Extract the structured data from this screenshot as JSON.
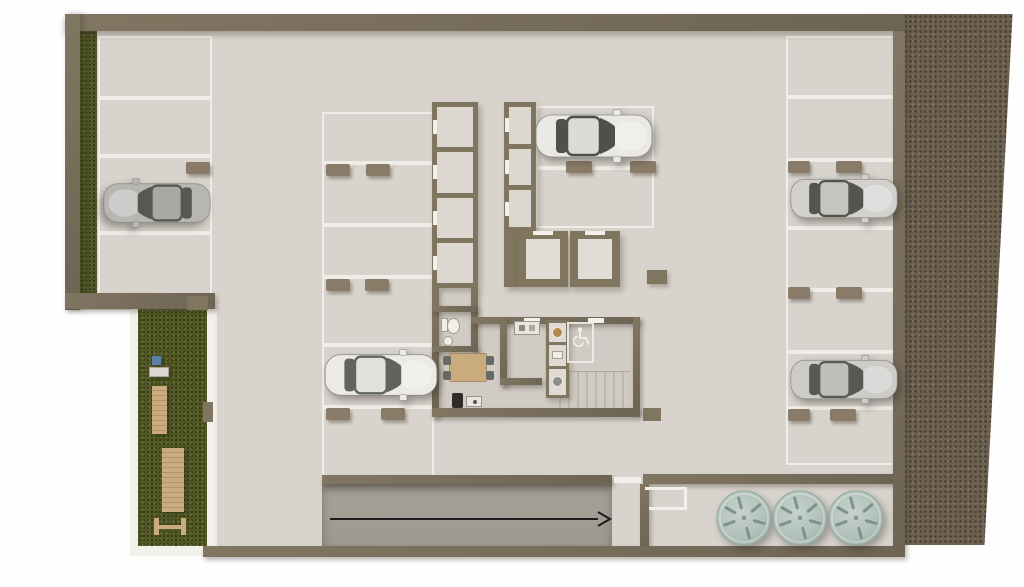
{
  "colors": {
    "page": "#fefefe",
    "wall": "#80755f",
    "wall_dark": "#6c6252",
    "floor": "#d8d4cd",
    "floor_core": "#d0cbc4",
    "ramp": "#a39e95",
    "line": "#f2f0ea",
    "hedge": "#4e5423",
    "grass": "#525823",
    "terrain": "#6d604f",
    "tank": "#b4c3bc",
    "tank_mark": "#7e938b",
    "wheel_stop": "#897b67",
    "wood": "#c9ab7d",
    "arrow": "#1d1d1d"
  },
  "symbols": {
    "accessible_parking": "wheelchair",
    "drive_direction": "arrow-right"
  },
  "plan": {
    "parking": {
      "total_spaces": 19,
      "columns": [
        {
          "id": "left",
          "x": 98,
          "w": 114,
          "lines_y": [
            36,
            98,
            156,
            233,
            298
          ],
          "stops": [
            {
              "x": 186,
              "y": 162,
              "w": 24
            }
          ]
        },
        {
          "id": "middle",
          "x": 322,
          "w": 112,
          "lines_y": [
            112,
            163,
            225,
            277,
            345,
            407,
            478
          ],
          "stops": [
            {
              "x": 326,
              "y": 164,
              "w": 24
            },
            {
              "x": 366,
              "y": 164,
              "w": 24
            },
            {
              "x": 326,
              "y": 279,
              "w": 24
            },
            {
              "x": 365,
              "y": 279,
              "w": 24
            },
            {
              "x": 326,
              "y": 408,
              "w": 24
            },
            {
              "x": 381,
              "y": 408,
              "w": 24
            }
          ]
        },
        {
          "id": "top-center",
          "x": 536,
          "w": 118,
          "lines_y": [
            106,
            168,
            228
          ],
          "stops": [
            {
              "x": 566,
              "y": 161,
              "w": 26
            },
            {
              "x": 630,
              "y": 161,
              "w": 26
            }
          ]
        },
        {
          "id": "right",
          "x": 786,
          "w": 112,
          "lines_y": [
            36,
            97,
            160,
            228,
            290,
            352,
            408,
            465
          ],
          "stops": [
            {
              "x": 788,
              "y": 161,
              "w": 22
            },
            {
              "x": 836,
              "y": 161,
              "w": 26
            },
            {
              "x": 788,
              "y": 287,
              "w": 22
            },
            {
              "x": 836,
              "y": 287,
              "w": 26
            },
            {
              "x": 788,
              "y": 409,
              "w": 22
            },
            {
              "x": 830,
              "y": 409,
              "w": 26
            }
          ]
        }
      ]
    },
    "storage_strips": [
      {
        "id": "deposits-left",
        "x": 432,
        "y": 102,
        "w": 46,
        "h": 186,
        "cells": 4
      },
      {
        "id": "deposits-mid",
        "x": 504,
        "y": 102,
        "w": 32,
        "h": 130,
        "cells": 3
      }
    ],
    "vehicles": [
      {
        "name": "car-sedan-gray",
        "x": 102,
        "y": 178,
        "w": 110,
        "h": 50,
        "facing": "left",
        "body": "#b7b6b3",
        "roof": "#a9a8a5",
        "glass": "#565951"
      },
      {
        "name": "car-coupe-white",
        "x": 323,
        "y": 349,
        "w": 116,
        "h": 52,
        "facing": "right",
        "body": "#eceae6",
        "roof": "#e2e0dc",
        "glass": "#60645c"
      },
      {
        "name": "car-sedan-white",
        "x": 534,
        "y": 109,
        "w": 120,
        "h": 54,
        "facing": "right",
        "body": "#e9e8e4",
        "roof": "#dcdbd7",
        "glass": "#4e514b"
      },
      {
        "name": "car-sedan-silver",
        "x": 789,
        "y": 172,
        "w": 110,
        "h": 53,
        "facing": "right",
        "body": "#d2d1ce",
        "roof": "#c5c4c1",
        "glass": "#53564f"
      },
      {
        "name": "car-suv-silver",
        "x": 789,
        "y": 352,
        "w": 110,
        "h": 55,
        "facing": "right",
        "body": "#cccbc8",
        "roof": "#bfbebb",
        "glass": "#575a54"
      }
    ],
    "water_tanks": {
      "r": 28,
      "items": [
        {
          "cx": 744,
          "cy": 518
        },
        {
          "cx": 800,
          "cy": 518
        },
        {
          "cx": 856,
          "cy": 518
        }
      ]
    },
    "garden_items": [
      {
        "type": "cube",
        "x": 152,
        "y": 356,
        "w": 9,
        "h": 9,
        "color": "#5b80a8"
      },
      {
        "type": "lounge",
        "x": 149,
        "y": 367,
        "w": 20,
        "h": 10,
        "color": "#dad7d1"
      },
      {
        "type": "deck",
        "x": 152,
        "y": 386,
        "w": 15,
        "h": 48,
        "color": "#c9ab7d"
      },
      {
        "type": "deck",
        "x": 162,
        "y": 448,
        "w": 22,
        "h": 64,
        "color": "#c9ab7d"
      },
      {
        "type": "bench",
        "x": 154,
        "y": 518,
        "w": 32,
        "h": 17,
        "color": "#c9ab7d"
      }
    ],
    "ramp_arrow": {
      "x1": 330,
      "y1": 519,
      "x2": 608,
      "y2": 519
    }
  }
}
